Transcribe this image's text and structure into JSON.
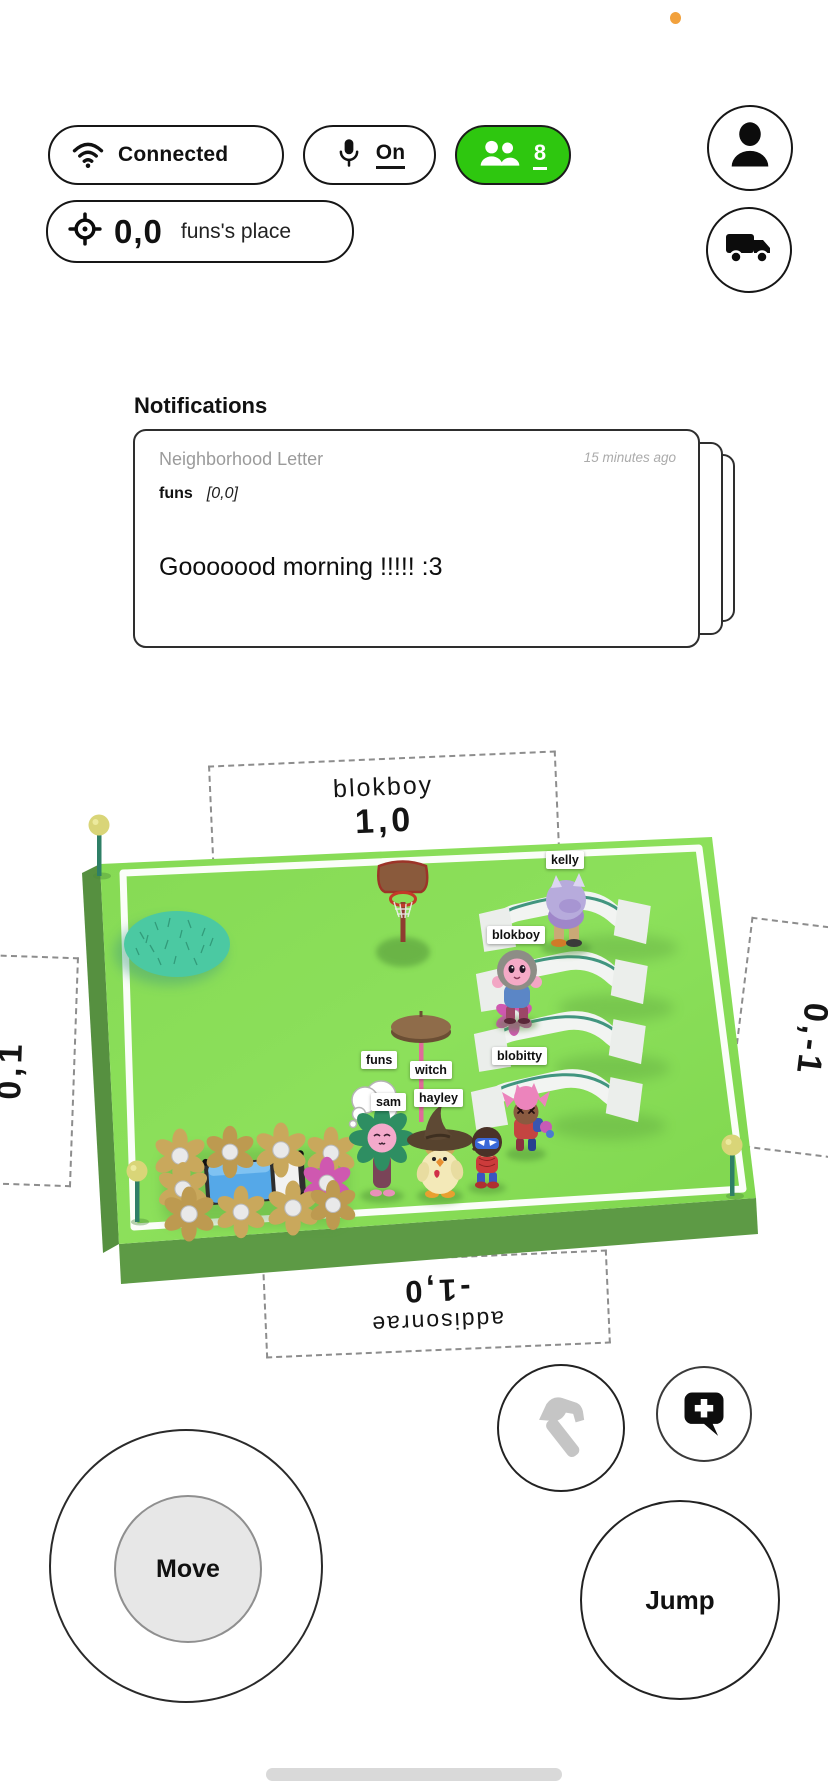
{
  "status": {
    "recording_dot_color": "#f2a13c"
  },
  "top_bar": {
    "connection": {
      "label": "Connected"
    },
    "mic": {
      "label": "On"
    },
    "players": {
      "count": "8",
      "pill_color": "#2ec70f"
    },
    "location": {
      "coords": "0,0",
      "place_name": "funs's place"
    }
  },
  "notifications": {
    "title": "Notifications",
    "letter": {
      "category": "Neighborhood Letter",
      "timestamp": "15 minutes ago",
      "author": "funs",
      "author_coords": "[0,0]",
      "message": "Gooooood morning !!!!! :3"
    }
  },
  "scene": {
    "signs": {
      "top": {
        "name": "blokboy",
        "coords": "1,0"
      },
      "bottom": {
        "name": "addisonrae",
        "coords": "-1,0"
      },
      "left": {
        "coords": "0,1"
      },
      "right": {
        "coords": "0,-1"
      }
    },
    "player_tags": [
      {
        "label": "kelly"
      },
      {
        "label": "blokboy"
      },
      {
        "label": "blobitty"
      },
      {
        "label": "funs"
      },
      {
        "label": "witch"
      },
      {
        "label": "sam"
      },
      {
        "label": "hayley"
      }
    ],
    "colors": {
      "grass_top": "#8ce05b",
      "grass_side": "#5d9a45",
      "rug": "#4bc9a2",
      "ramp_edge": "#2e8b72"
    }
  },
  "controls": {
    "move_label": "Move",
    "jump_label": "Jump"
  },
  "icons": {
    "connection": "wifi-icon",
    "mic": "mic-icon",
    "players": "people-icon",
    "profile": "person-icon",
    "delivery": "truck-icon",
    "location": "crosshair-icon",
    "build": "hammer-icon",
    "chat": "chat-add-icon"
  }
}
